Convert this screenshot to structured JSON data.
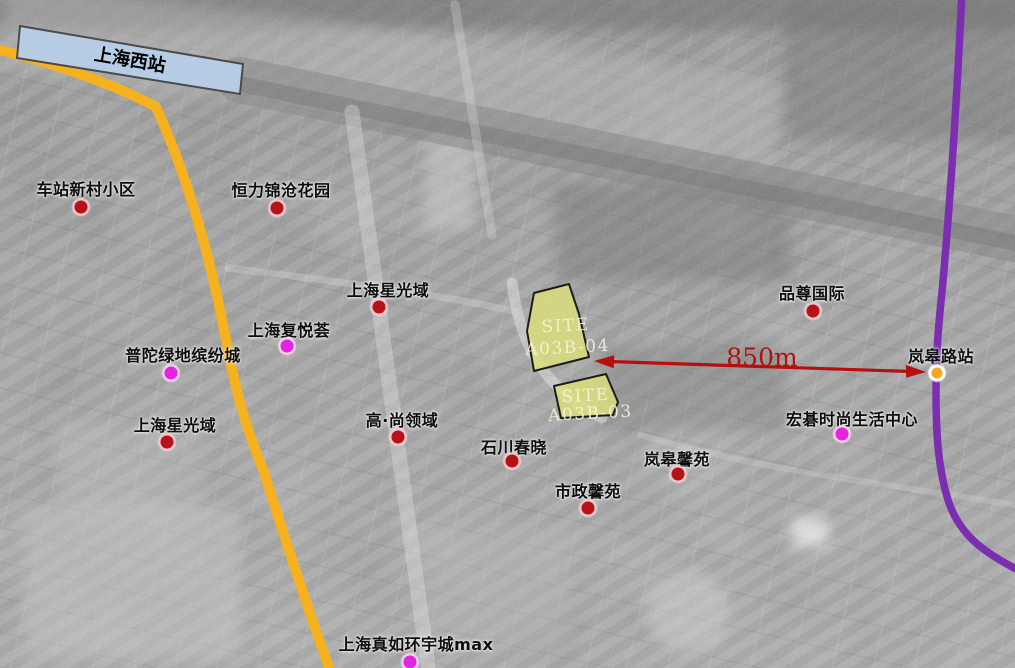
{
  "station_box": {
    "label": "上海西站"
  },
  "distance_label": "850m",
  "sites": [
    {
      "line1": "SITE",
      "line2": "A03B-04"
    },
    {
      "line1": "SITE",
      "line2": "A03B-03"
    }
  ],
  "markers": [
    {
      "label": "车站新村小区",
      "type": "red",
      "label_x": 86,
      "label_y": 188,
      "dot_x": 81,
      "dot_y": 207
    },
    {
      "label": "恒力锦沧花园",
      "type": "red",
      "label_x": 281,
      "label_y": 189,
      "dot_x": 277,
      "dot_y": 208
    },
    {
      "label": "上海星光域",
      "type": "red",
      "label_x": 388,
      "label_y": 289,
      "dot_x": 379,
      "dot_y": 307
    },
    {
      "label": "上海复悦荟",
      "type": "magenta",
      "label_x": 289,
      "label_y": 329,
      "dot_x": 287,
      "dot_y": 346
    },
    {
      "label": "普陀绿地缤纷城",
      "type": "magenta",
      "label_x": 183,
      "label_y": 354,
      "dot_x": 171,
      "dot_y": 373
    },
    {
      "label": "上海星光域",
      "type": "red",
      "label_x": 175,
      "label_y": 424,
      "dot_x": 167,
      "dot_y": 442
    },
    {
      "label": "高·尚领域",
      "type": "red",
      "label_x": 402,
      "label_y": 419,
      "dot_x": 398,
      "dot_y": 437
    },
    {
      "label": "石川春晓",
      "type": "red",
      "label_x": 514,
      "label_y": 446,
      "dot_x": 512,
      "dot_y": 461
    },
    {
      "label": "市政馨苑",
      "type": "red",
      "label_x": 588,
      "label_y": 490,
      "dot_x": 588,
      "dot_y": 508
    },
    {
      "label": "岚皋馨苑",
      "type": "red",
      "label_x": 677,
      "label_y": 458,
      "dot_x": 678,
      "dot_y": 474
    },
    {
      "label": "品尊国际",
      "type": "red",
      "label_x": 812,
      "label_y": 292,
      "dot_x": 813,
      "dot_y": 311
    },
    {
      "label": "宏碁时尚生活中心",
      "type": "magenta",
      "label_x": 852,
      "label_y": 418,
      "dot_x": 842,
      "dot_y": 434
    },
    {
      "label": "上海真如环宇城max",
      "type": "magenta",
      "label_x": 416,
      "label_y": 643,
      "dot_x": 410,
      "dot_y": 662
    },
    {
      "label": "岚皋路站",
      "type": "station",
      "label_x": 941,
      "label_y": 355,
      "dot_x": 937,
      "dot_y": 373
    }
  ],
  "colors": {
    "red_dot": "#b5121a",
    "magenta_dot": "#e326dd",
    "station_dot": "#f5a623",
    "arrow_red": "#b50f0f",
    "site_fill": "#dcdf7a",
    "site_text": "#f7f4da",
    "metro_purple": "#7b2fb0",
    "road_yellow": "#f6b11e",
    "station_box_fill": "#b7cde8"
  }
}
